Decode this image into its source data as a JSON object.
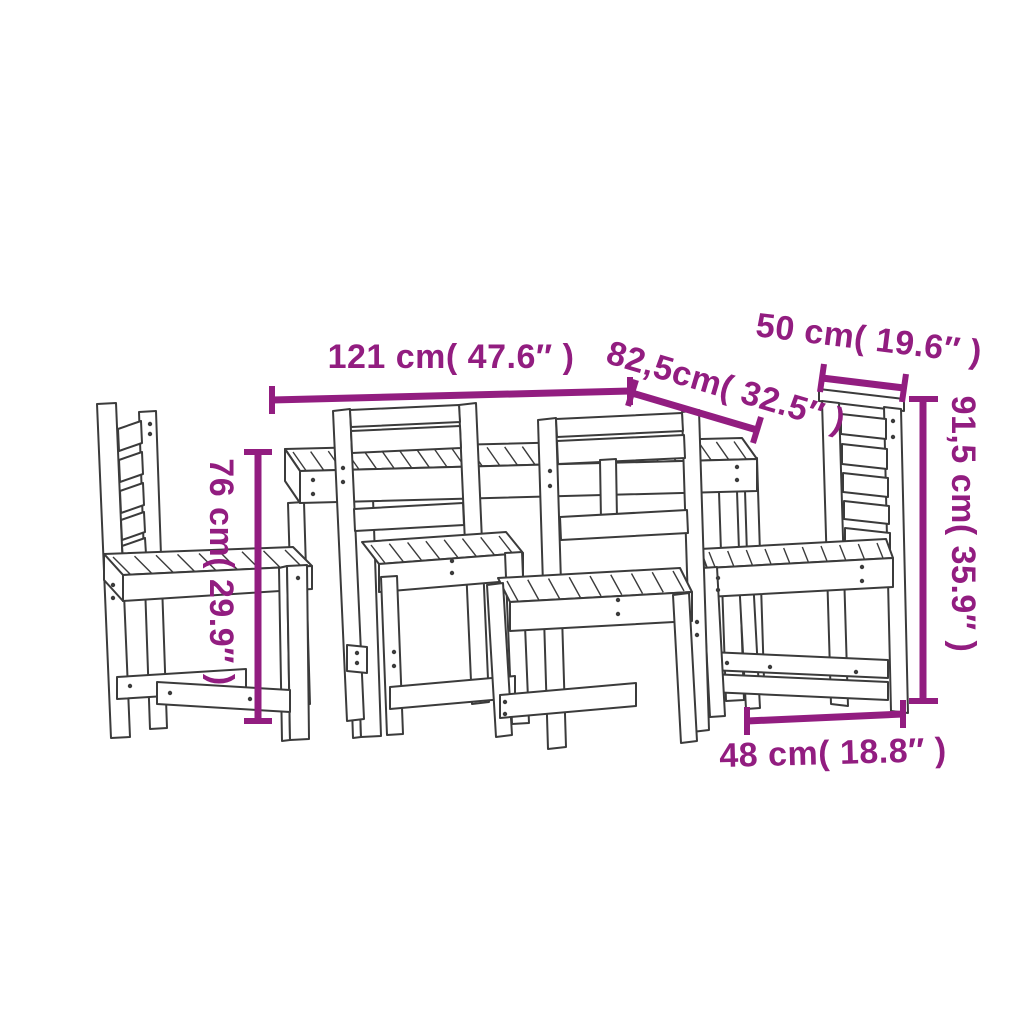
{
  "canvas": {
    "width": 1024,
    "height": 1024,
    "background": "#ffffff"
  },
  "drawing": {
    "alt": "Line drawing of a 5 piece wooden garden dining set: table with slatted top and four ladder-back chairs",
    "line_color": "#3b3b3b",
    "accent_color": "#921D80"
  },
  "dimensions": [
    {
      "id": "table-length",
      "cm": "121",
      "inches": "47.6",
      "label": "121 cm( 47.6″ )"
    },
    {
      "id": "table-depth",
      "cm": "82,5",
      "inches": "32.5",
      "label": "82,5cm( 32.5″ )"
    },
    {
      "id": "chair-width",
      "cm": "50",
      "inches": "19.6",
      "label": "50 cm( 19.6″ )"
    },
    {
      "id": "chair-height",
      "cm": "91,5",
      "inches": "35.9",
      "label": "91,5 cm( 35.9″ )"
    },
    {
      "id": "table-height",
      "cm": "76",
      "inches": "29.9",
      "label": "76 cm( 29.9″ )"
    },
    {
      "id": "chair-depth",
      "cm": "48",
      "inches": "18.8",
      "label": "48 cm( 18.8″ )"
    }
  ]
}
